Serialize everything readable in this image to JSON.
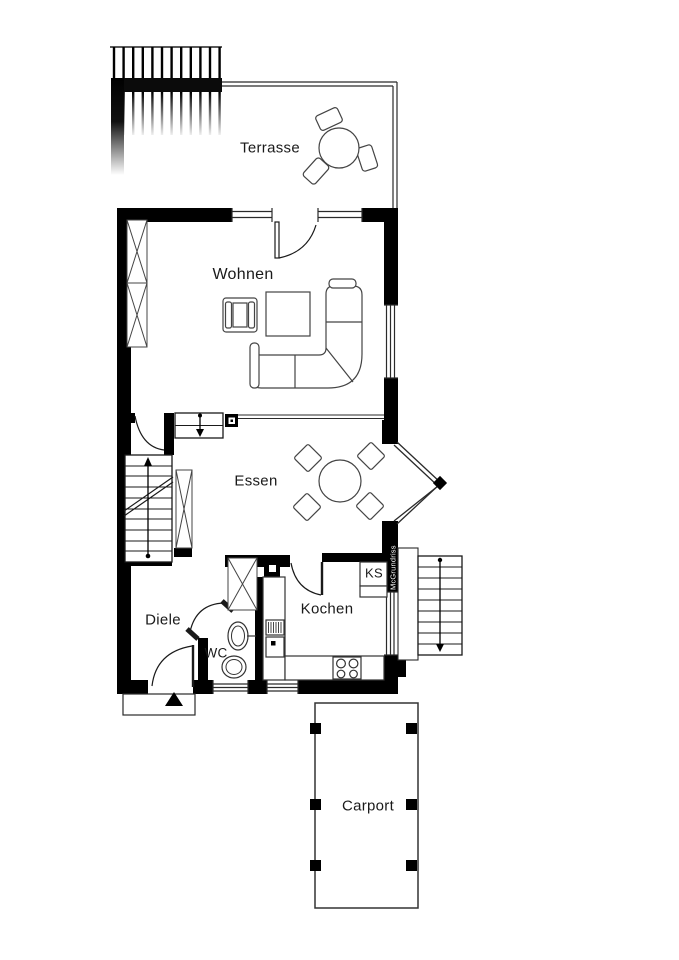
{
  "plan": {
    "labels": {
      "terrasse": "Terrasse",
      "wohnen": "Wohnen",
      "essen": "Essen",
      "kochen": "Kochen",
      "ks": "KS",
      "diele": "Diele",
      "wc": "WC",
      "carport": "Carport"
    },
    "watermark": "McGrundriss",
    "colors": {
      "wall": "#000000",
      "line": "#333333",
      "background": "#ffffff",
      "watermark_text": "#ffffff"
    }
  }
}
